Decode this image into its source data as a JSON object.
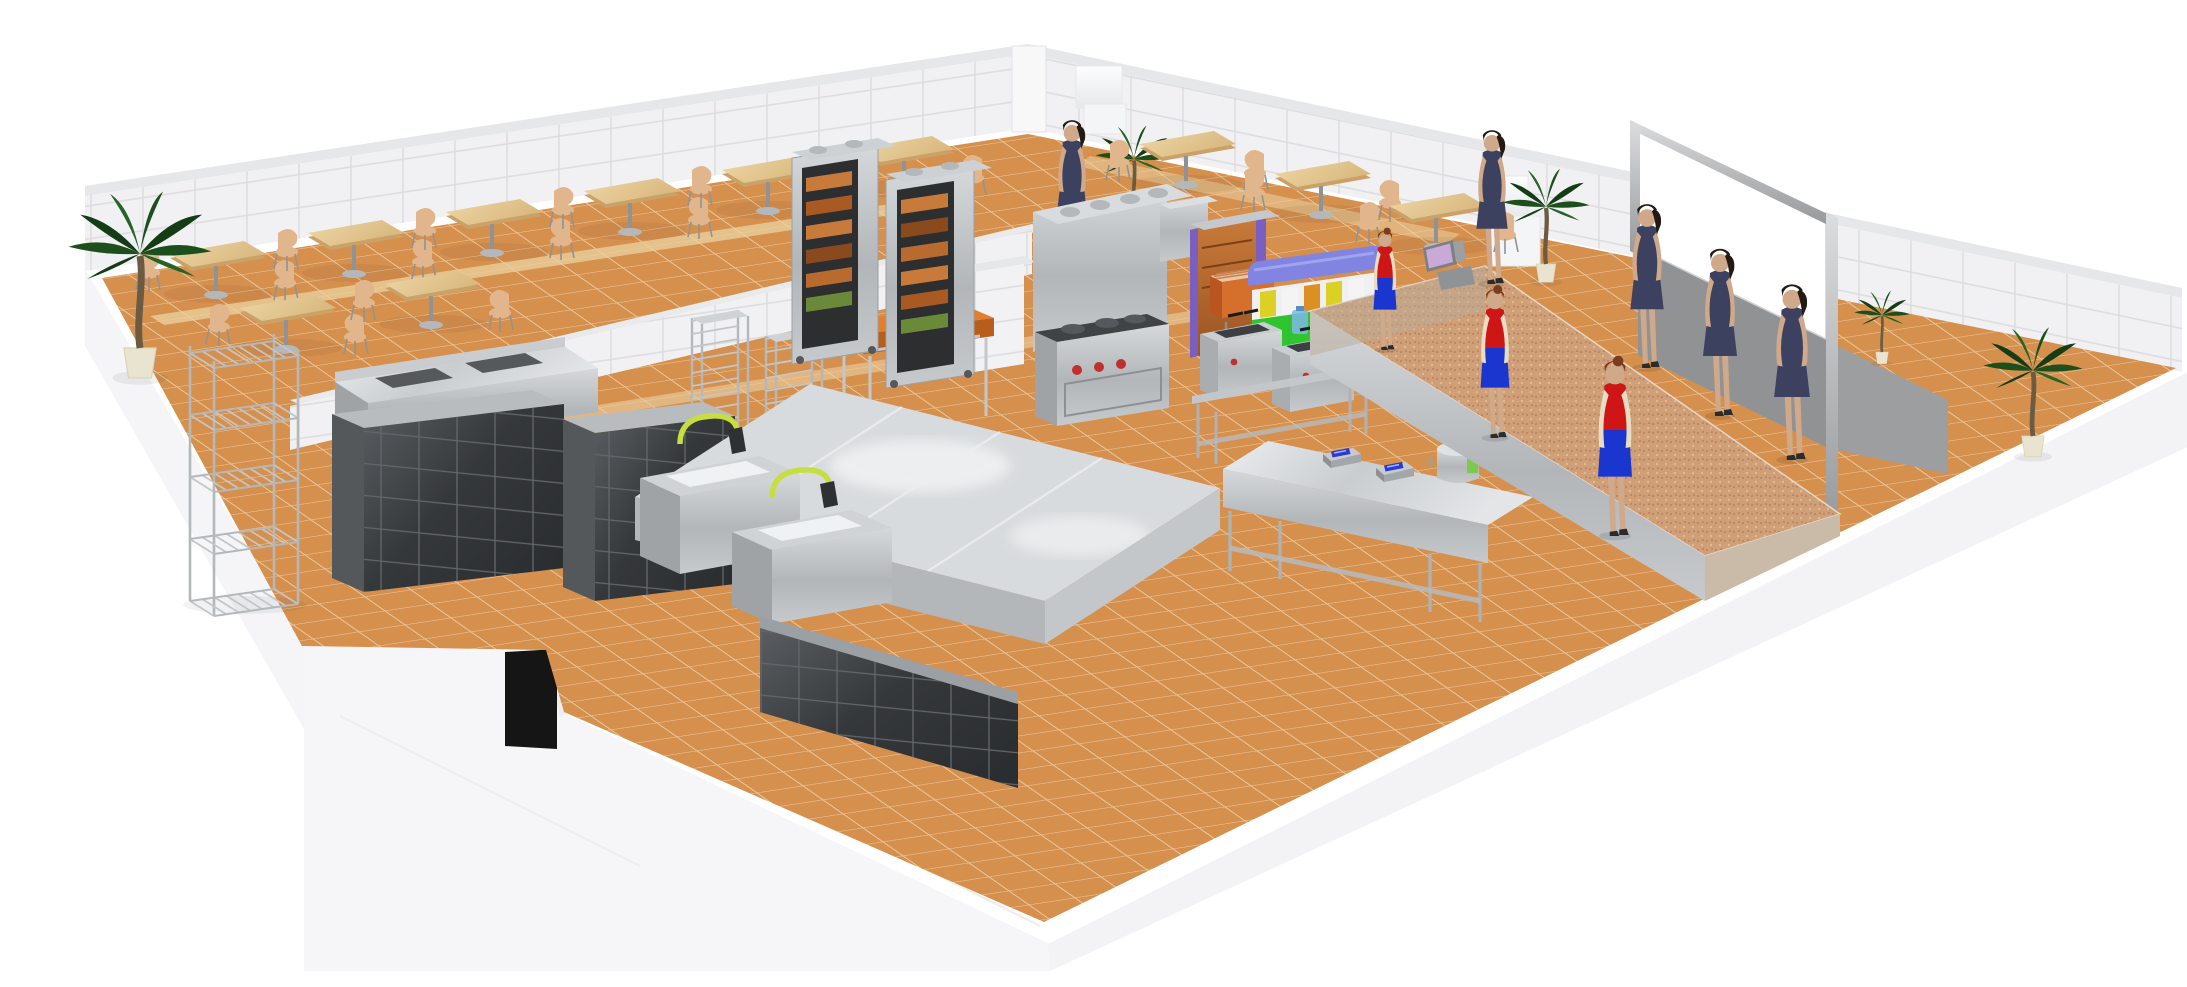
{
  "scene": {
    "title": "3D perspective render of a self-service cafeteria floor plan with dining hall, commercial kitchen, serving counter and queuing customers",
    "render_style": "isometric-perspective architectural visualization, white background, cutaway walls",
    "areas": [
      {
        "id": "dining-area",
        "label": "Dining hall with two-seat wooden tables on orange tile floor"
      },
      {
        "id": "kitchen",
        "label": "Commercial kitchen with stainless steel equipment"
      },
      {
        "id": "serving-line",
        "label": "Self-service line with tray dispenser, POS register and granite counter"
      },
      {
        "id": "dishwashing-area",
        "label": "Dark tiled wash-up zone with pre-rinse sinks"
      },
      {
        "id": "queue-corridor",
        "label": "Customer corridor along serving counter beside grey partition and menu screen"
      }
    ],
    "objects": [
      {
        "name": "dining-table",
        "count": 11,
        "top_color": "#e8cd9c",
        "base_color": "#9aa0a4"
      },
      {
        "name": "dining-chair",
        "count": 22,
        "color": "#e2b68c"
      },
      {
        "name": "palm-plant",
        "count": 5,
        "foliage_color": "#1d4f1d",
        "pot_color": "#e9e4cf"
      },
      {
        "name": "wire-shelving-rack",
        "count": 1,
        "color": "#b4b8bb"
      },
      {
        "name": "speed-rack-trolley",
        "count": 2,
        "color": "#b4b8bb"
      },
      {
        "name": "butcher-block-table",
        "count": 1,
        "top_color": "#e0802e"
      },
      {
        "name": "display-oven",
        "count": 2,
        "body_color": "#c3c7ca",
        "food_color": "#c77a3a"
      },
      {
        "name": "combi-oven-block",
        "count": 1,
        "color": "#c3c7ca"
      },
      {
        "name": "cooking-range",
        "count": 1,
        "knob_color": "#c03030"
      },
      {
        "name": "deep-fryer",
        "count": 2,
        "color": "#caced1"
      },
      {
        "name": "bain-marie",
        "count": 1,
        "color": "#c8cbce"
      },
      {
        "name": "heated-cabinet",
        "count": 2,
        "body_color": "#b0612f",
        "trim_color": "#7a5fc0"
      },
      {
        "name": "roller-grill",
        "count": 1,
        "color": "#c96028"
      },
      {
        "name": "tray-dispenser",
        "count": 1,
        "lid_color": "#8184e0",
        "base_color": "#2ec52e",
        "tray_colors": [
          "#ddd024",
          "#f2f2f2",
          "#dd8f24"
        ]
      },
      {
        "name": "digital-scale",
        "count": 2,
        "display_color": "#2a3bd0"
      },
      {
        "name": "stock-pot",
        "count": 1,
        "color": "#d5d8da"
      },
      {
        "name": "prep-island",
        "count": 1,
        "color": "#d8dbdd"
      },
      {
        "name": "pre-rinse-sink",
        "count": 2,
        "faucet_color": "#c6de3f"
      },
      {
        "name": "pos-terminal",
        "count": 1,
        "screen_color": "#c9a9d6"
      },
      {
        "name": "serving-counter",
        "count": 1,
        "top_color": "#cf9f78"
      },
      {
        "name": "menu-screen",
        "count": 1,
        "frame_color": "#b9babc",
        "panel_color": "#ffffff"
      },
      {
        "name": "partition-wall",
        "count": 1,
        "color": "#909294"
      },
      {
        "name": "refrigerator-white",
        "count": 2,
        "color": "#fbfbfc",
        "sticker_color": "#e8d020"
      },
      {
        "name": "drink-dispenser",
        "count": 1,
        "color": "#c22020"
      },
      {
        "name": "water-jug",
        "count": 1,
        "color": "#7db8e8"
      },
      {
        "name": "trash-bin",
        "count": 1,
        "color": "#9aa6b2"
      },
      {
        "name": "white-storage-boxes",
        "count": 2,
        "color": "#f8f8f9"
      },
      {
        "name": "doorway-opening",
        "count": 1,
        "color": "#151515"
      }
    ],
    "people": {
      "staff": {
        "count": 3,
        "top_color": "#cf1616",
        "skirt_color": "#1b35cf",
        "glove_color": "#e8ddc2",
        "hair_color": "#7a3c1e"
      },
      "customers": {
        "count": 5,
        "dress_color": "#3c415f",
        "hair_color": "#231a12"
      }
    },
    "palette": {
      "bg": "#ffffff",
      "wall_face": "#f1f1f3",
      "wall_line": "#dcdcde",
      "wall_cap": "#e6e7e9",
      "wall_ext": "#f5f5f7",
      "floor": "#d6904e",
      "floor_grout": "#e9c9a0",
      "floor_light": "#ead1a2",
      "granite": "#cf9f78",
      "steel_light": "#dfe2e4",
      "steel_mid": "#b4b8bb",
      "steel_dark": "#8f9396",
      "dark_equip": "#3a3d40",
      "dark_line": "#63676b",
      "wood": "#e8cd9c",
      "wood_dark": "#caa268",
      "chair": "#e2b68c",
      "butcher": "#e0802e",
      "palm": "#1d4f1d",
      "palm_dark": "#153d15",
      "palm_lite": "#266326",
      "trunk": "#6b5b43",
      "pot": "#e9e4cf",
      "navy": "#3c415f",
      "red": "#cf1616",
      "blue": "#1b35cf",
      "skin": "#cfa98a",
      "glove": "#e8ddc2",
      "hair": "#231a12",
      "hair_staff": "#7a3c1e",
      "tray_blue": "#8184e0",
      "tray_green": "#2ec52e",
      "tray_yellow": "#ddd024",
      "tray_orange": "#dd8f24",
      "copper": "#b0612f",
      "purple": "#7a5fc0",
      "pos_screen": "#c9a9d6",
      "scale_blue": "#2a3bd0",
      "lime": "#c6de3f",
      "red_knob": "#c03030",
      "screen_frame": "#b9babc",
      "partition": "#909294",
      "black": "#151515"
    }
  }
}
